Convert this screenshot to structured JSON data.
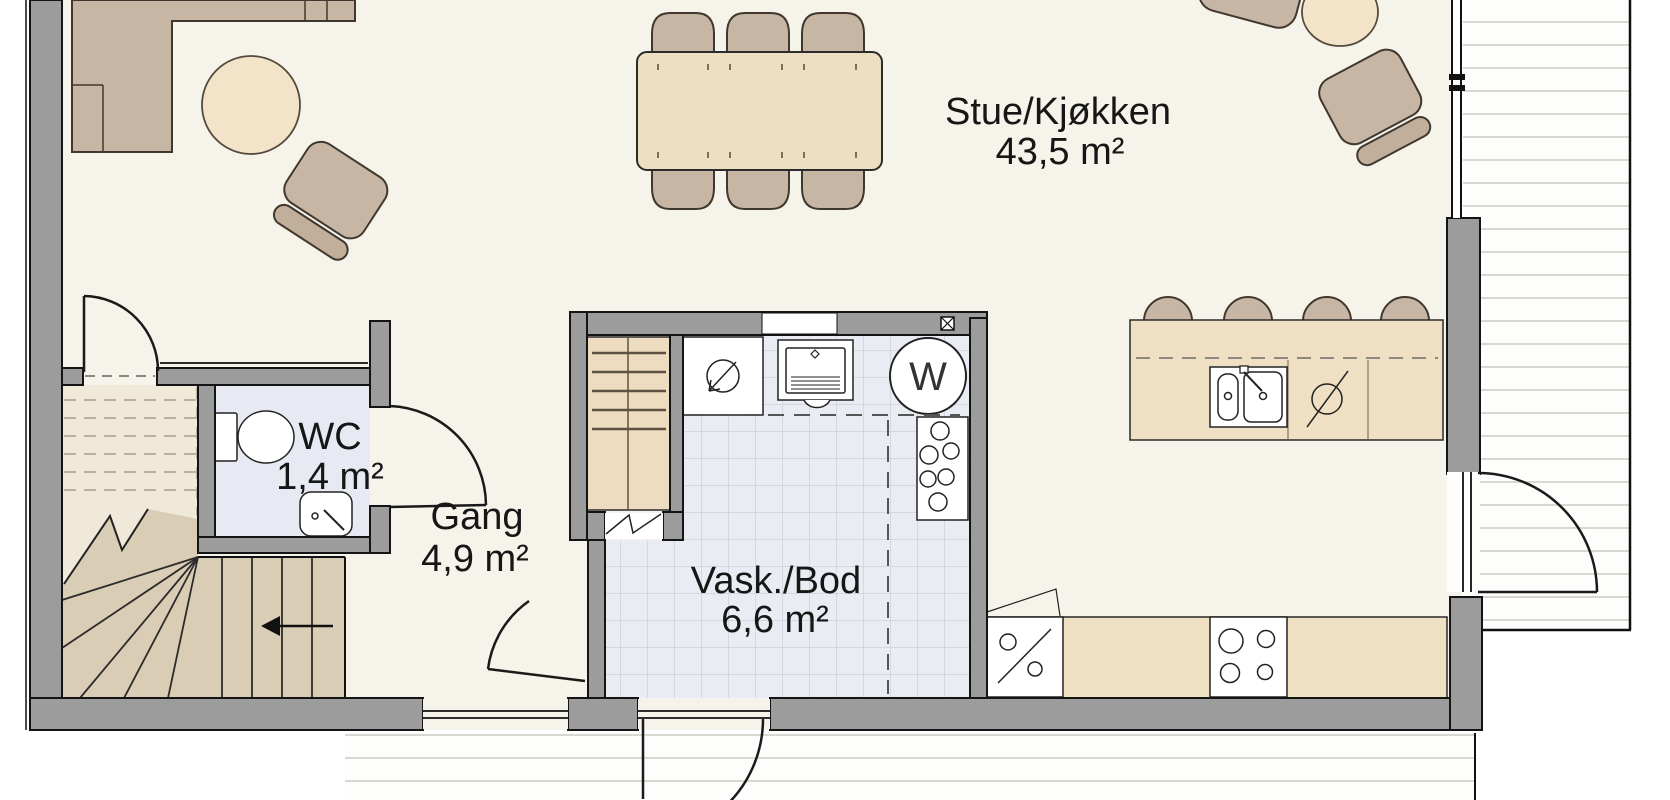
{
  "plan": {
    "type": "apartment-floor-plan",
    "rooms": {
      "stue": {
        "label": "Stue/Kjøkken",
        "area": "43,5 m²"
      },
      "gang": {
        "label": "Gang",
        "area": "4,9 m²"
      },
      "wc": {
        "label": "WC",
        "area": "1,4 m²"
      },
      "vask": {
        "label": "Vask./Bod",
        "area": "6,6 m²"
      }
    },
    "symbols": {
      "washer_letter": "W"
    },
    "colors": {
      "floor": "#f6f3ea",
      "wall": "#9c9c9c",
      "furniture_brown": "#c8b6a4",
      "wood_beige": "#eedec2",
      "tile_floor": "#e9ecf2",
      "wc_floor": "#e7eaf2",
      "stair_light": "#f0e9da",
      "stair_dark": "#dacdb5",
      "outline": "#141414"
    }
  }
}
